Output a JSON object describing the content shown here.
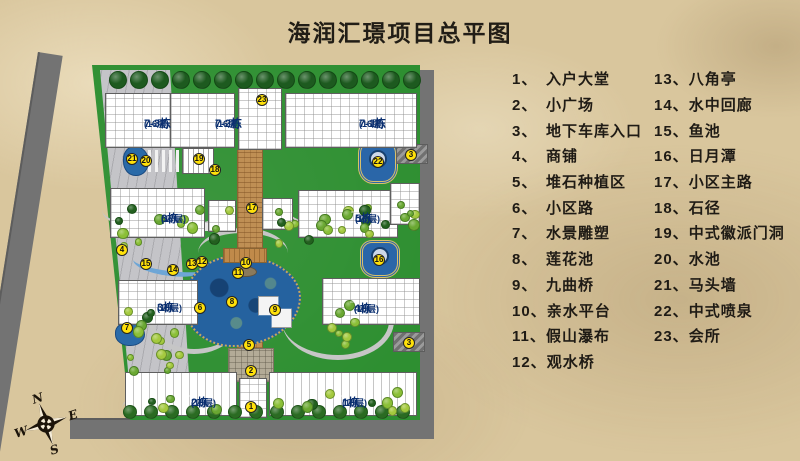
{
  "title": "海润汇璟项目总平图",
  "legend": {
    "columns": [
      {
        "items": [
          {
            "num": "1",
            "name": "入户大堂"
          },
          {
            "num": "2",
            "name": "小广场"
          },
          {
            "num": "3",
            "name": "地下车库入口"
          },
          {
            "num": "4",
            "name": "商铺"
          },
          {
            "num": "5",
            "name": "堆石种植区"
          },
          {
            "num": "6",
            "name": "小区路"
          },
          {
            "num": "7",
            "name": "水景雕塑"
          },
          {
            "num": "8",
            "name": "莲花池"
          },
          {
            "num": "9",
            "name": "九曲桥"
          },
          {
            "num": "10",
            "name": "亲水平台"
          },
          {
            "num": "11",
            "name": "假山瀑布"
          },
          {
            "num": "12",
            "name": "观水桥"
          }
        ]
      },
      {
        "items": [
          {
            "num": "13",
            "name": "八角亭"
          },
          {
            "num": "14",
            "name": "水中回廊"
          },
          {
            "num": "15",
            "name": "鱼池"
          },
          {
            "num": "16",
            "name": "日月潭"
          },
          {
            "num": "17",
            "name": "小区主路"
          },
          {
            "num": "18",
            "name": "石径"
          },
          {
            "num": "19",
            "name": "中式徽派门洞"
          },
          {
            "num": "20",
            "name": "水池"
          },
          {
            "num": "21",
            "name": "马头墙"
          },
          {
            "num": "22",
            "name": "中式喷泉"
          },
          {
            "num": "23",
            "name": "会所"
          }
        ]
      }
    ]
  },
  "building_labels": [
    {
      "text": "7-3栋",
      "floors": "(16层)",
      "x": 114,
      "y": 57
    },
    {
      "text": "7-2栋",
      "floors": "(16层)",
      "x": 185,
      "y": 57
    },
    {
      "text": "7-1栋",
      "floors": "(16层)",
      "x": 329,
      "y": 57
    },
    {
      "text": "6栋",
      "floors": "(17层)",
      "x": 131,
      "y": 152
    },
    {
      "text": "5栋",
      "floors": "(17层)",
      "x": 325,
      "y": 152
    },
    {
      "text": "3栋",
      "floors": "(16层)",
      "x": 127,
      "y": 241
    },
    {
      "text": "4栋",
      "floors": "(16层)",
      "x": 324,
      "y": 242
    },
    {
      "text": "2栋",
      "floors": "(16层)",
      "x": 161,
      "y": 336
    },
    {
      "text": "1栋",
      "floors": "(16层)",
      "x": 312,
      "y": 336
    }
  ],
  "markers": [
    {
      "num": "23",
      "x": 232,
      "y": 40
    },
    {
      "num": "22",
      "x": 348,
      "y": 102
    },
    {
      "num": "3",
      "x": 381,
      "y": 95
    },
    {
      "num": "3",
      "x": 379,
      "y": 283
    },
    {
      "num": "21",
      "x": 102,
      "y": 99
    },
    {
      "num": "20",
      "x": 116,
      "y": 101
    },
    {
      "num": "19",
      "x": 169,
      "y": 99
    },
    {
      "num": "18",
      "x": 185,
      "y": 110
    },
    {
      "num": "17",
      "x": 222,
      "y": 148
    },
    {
      "num": "6",
      "x": 170,
      "y": 248
    },
    {
      "num": "4",
      "x": 92,
      "y": 190
    },
    {
      "num": "15",
      "x": 116,
      "y": 204
    },
    {
      "num": "14",
      "x": 143,
      "y": 210
    },
    {
      "num": "13",
      "x": 162,
      "y": 204
    },
    {
      "num": "12",
      "x": 172,
      "y": 202
    },
    {
      "num": "10",
      "x": 216,
      "y": 203
    },
    {
      "num": "11",
      "x": 208,
      "y": 213
    },
    {
      "num": "8",
      "x": 202,
      "y": 242
    },
    {
      "num": "9",
      "x": 245,
      "y": 250
    },
    {
      "num": "16",
      "x": 349,
      "y": 200
    },
    {
      "num": "7",
      "x": 97,
      "y": 268
    },
    {
      "num": "5",
      "x": 219,
      "y": 285
    },
    {
      "num": "2",
      "x": 221,
      "y": 311
    },
    {
      "num": "1",
      "x": 221,
      "y": 347
    }
  ],
  "compass": {
    "n": "N",
    "e": "E",
    "s": "S",
    "w": "W"
  },
  "colors": {
    "parchment": "#d9c69d",
    "lawn": "#2e8f31",
    "water": "#2a6aa8",
    "road_dark": "#737373",
    "path_gray": "#c6c6c6",
    "axis_brick": "#bf8f54",
    "marker_yellow": "#ffe10a",
    "label_bg": "#a8daf6",
    "label_text": "#0a2f70",
    "title_text": "#211d16"
  }
}
